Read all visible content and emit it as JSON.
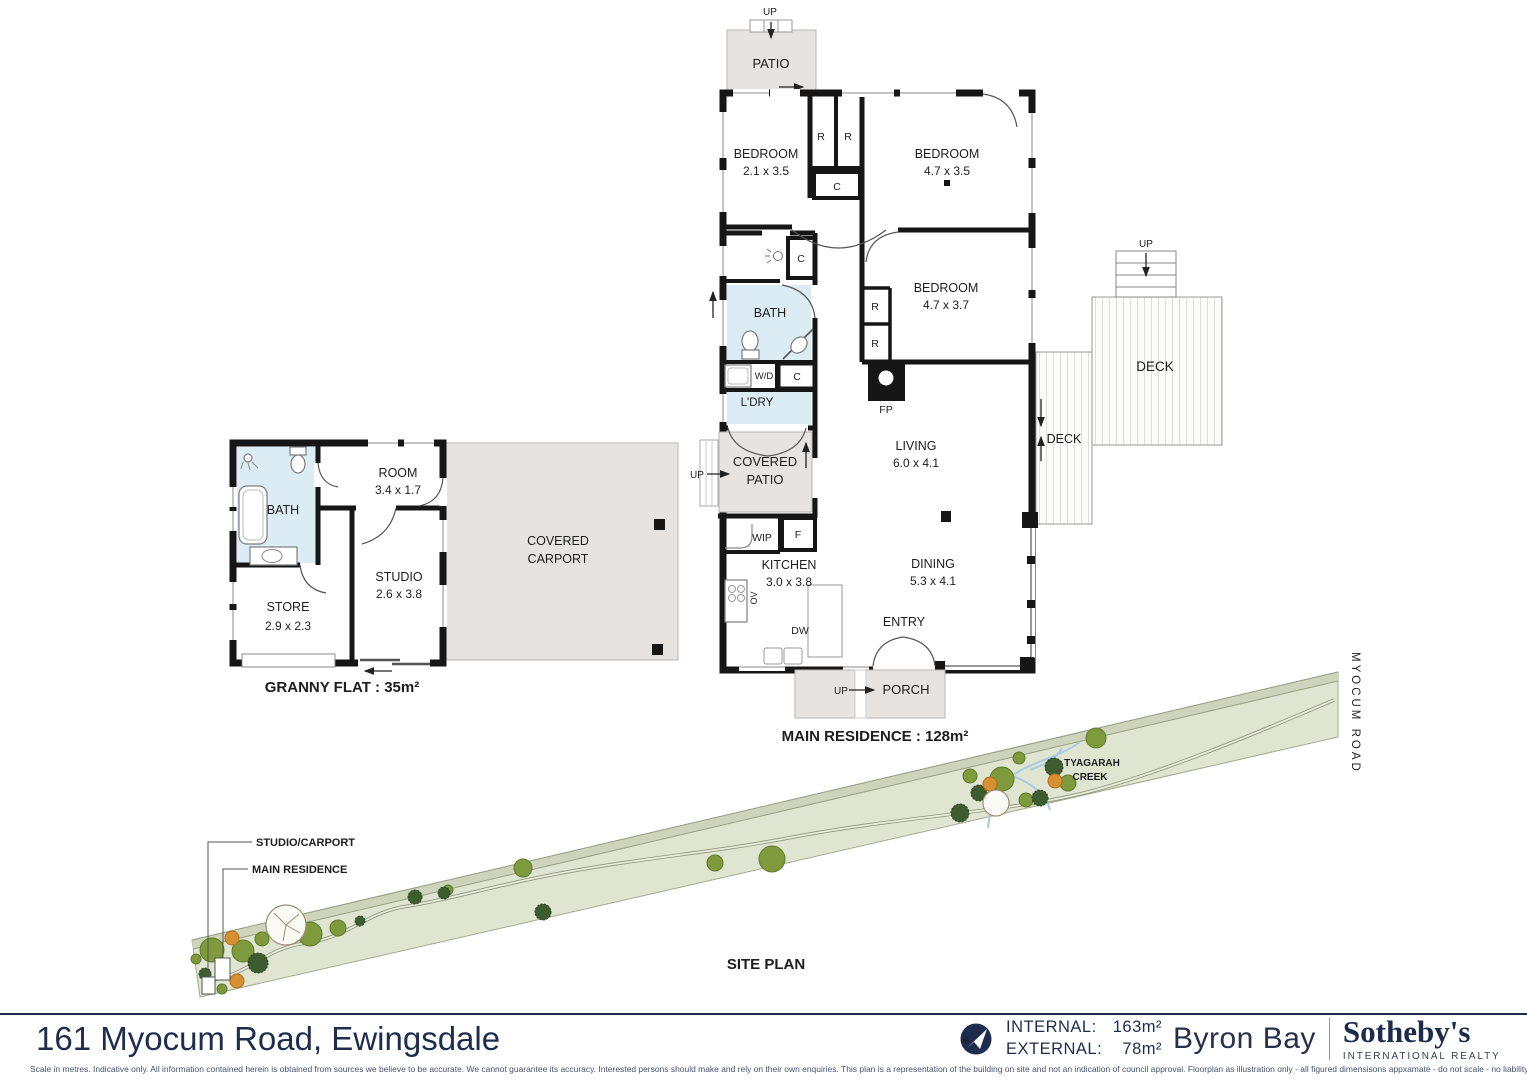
{
  "main_residence": {
    "caption": "MAIN RESIDENCE : 128m²",
    "patio": "PATIO",
    "bedroom1_name": "BEDROOM",
    "bedroom1_dims": "2.1 x 3.5",
    "bedroom2_name": "BEDROOM",
    "bedroom2_dims": "4.7 x 3.5",
    "bedroom3_name": "BEDROOM",
    "bedroom3_dims": "4.7 x 3.7",
    "bath": "BATH",
    "ldry": "L'DRY",
    "living_name": "LIVING",
    "living_dims": "6.0 x 4.1",
    "covered_patio_line1": "COVERED",
    "covered_patio_line2": "PATIO",
    "kitchen_name": "KITCHEN",
    "kitchen_dims": "3.0 x 3.8",
    "dining_name": "DINING",
    "dining_dims": "5.3 x 4.1",
    "entry": "ENTRY",
    "porch": "PORCH",
    "deck": "DECK",
    "codes": {
      "r": "R",
      "c": "C",
      "f": "F",
      "wip": "WIP",
      "wd": "W/D",
      "ov": "OV",
      "dw": "DW",
      "fp": "FP",
      "up": "UP"
    }
  },
  "granny_flat": {
    "caption": "GRANNY FLAT : 35m²",
    "bath": "BATH",
    "room_name": "ROOM",
    "room_dims": "3.4 x 1.7",
    "studio_name": "STUDIO",
    "studio_dims": "2.6 x 3.8",
    "store_name": "STORE",
    "store_dims": "2.9 x 2.3",
    "carport_line1": "COVERED",
    "carport_line2": "CARPORT"
  },
  "site_plan": {
    "title": "SITE PLAN",
    "studio_carport_label": "STUDIO/CARPORT",
    "main_residence_label": "MAIN RESIDENCE",
    "creek_line1": "TYAGARAH",
    "creek_line2": "CREEK",
    "road_label": "MYOCUM ROAD"
  },
  "footer": {
    "address": "161 Myocum Road, Ewingsdale",
    "internal_label": "INTERNAL:",
    "internal_value": "163m²",
    "external_label": "EXTERNAL:",
    "external_value": "78m²",
    "brand_left": "Byron Bay",
    "brand_right": "Sotheby's",
    "brand_sub": "INTERNATIONAL REALTY",
    "disclaimer": "Scale in metres.  Indicative only. All information contained herein is obtained from sources we believe to be accurate. We cannot guarantee its accuracy. Interested persons should make and rely on their own enquiries. This plan is a representation of the building on site and not an indication of council approval. Floorplan as illustration only - all figured dimensisons appxamate - do not scale - no liability accepted."
  },
  "colors": {
    "navy": "#1e2c4e",
    "patio_fill": "#e7e3e0",
    "bath_fill": "#dcecf5",
    "site_green": "#e0e5d2",
    "tree_olive": "#7e9a3d",
    "tree_dark": "#3d5c2f",
    "tree_orange": "#d79030",
    "wall": "#161616"
  }
}
